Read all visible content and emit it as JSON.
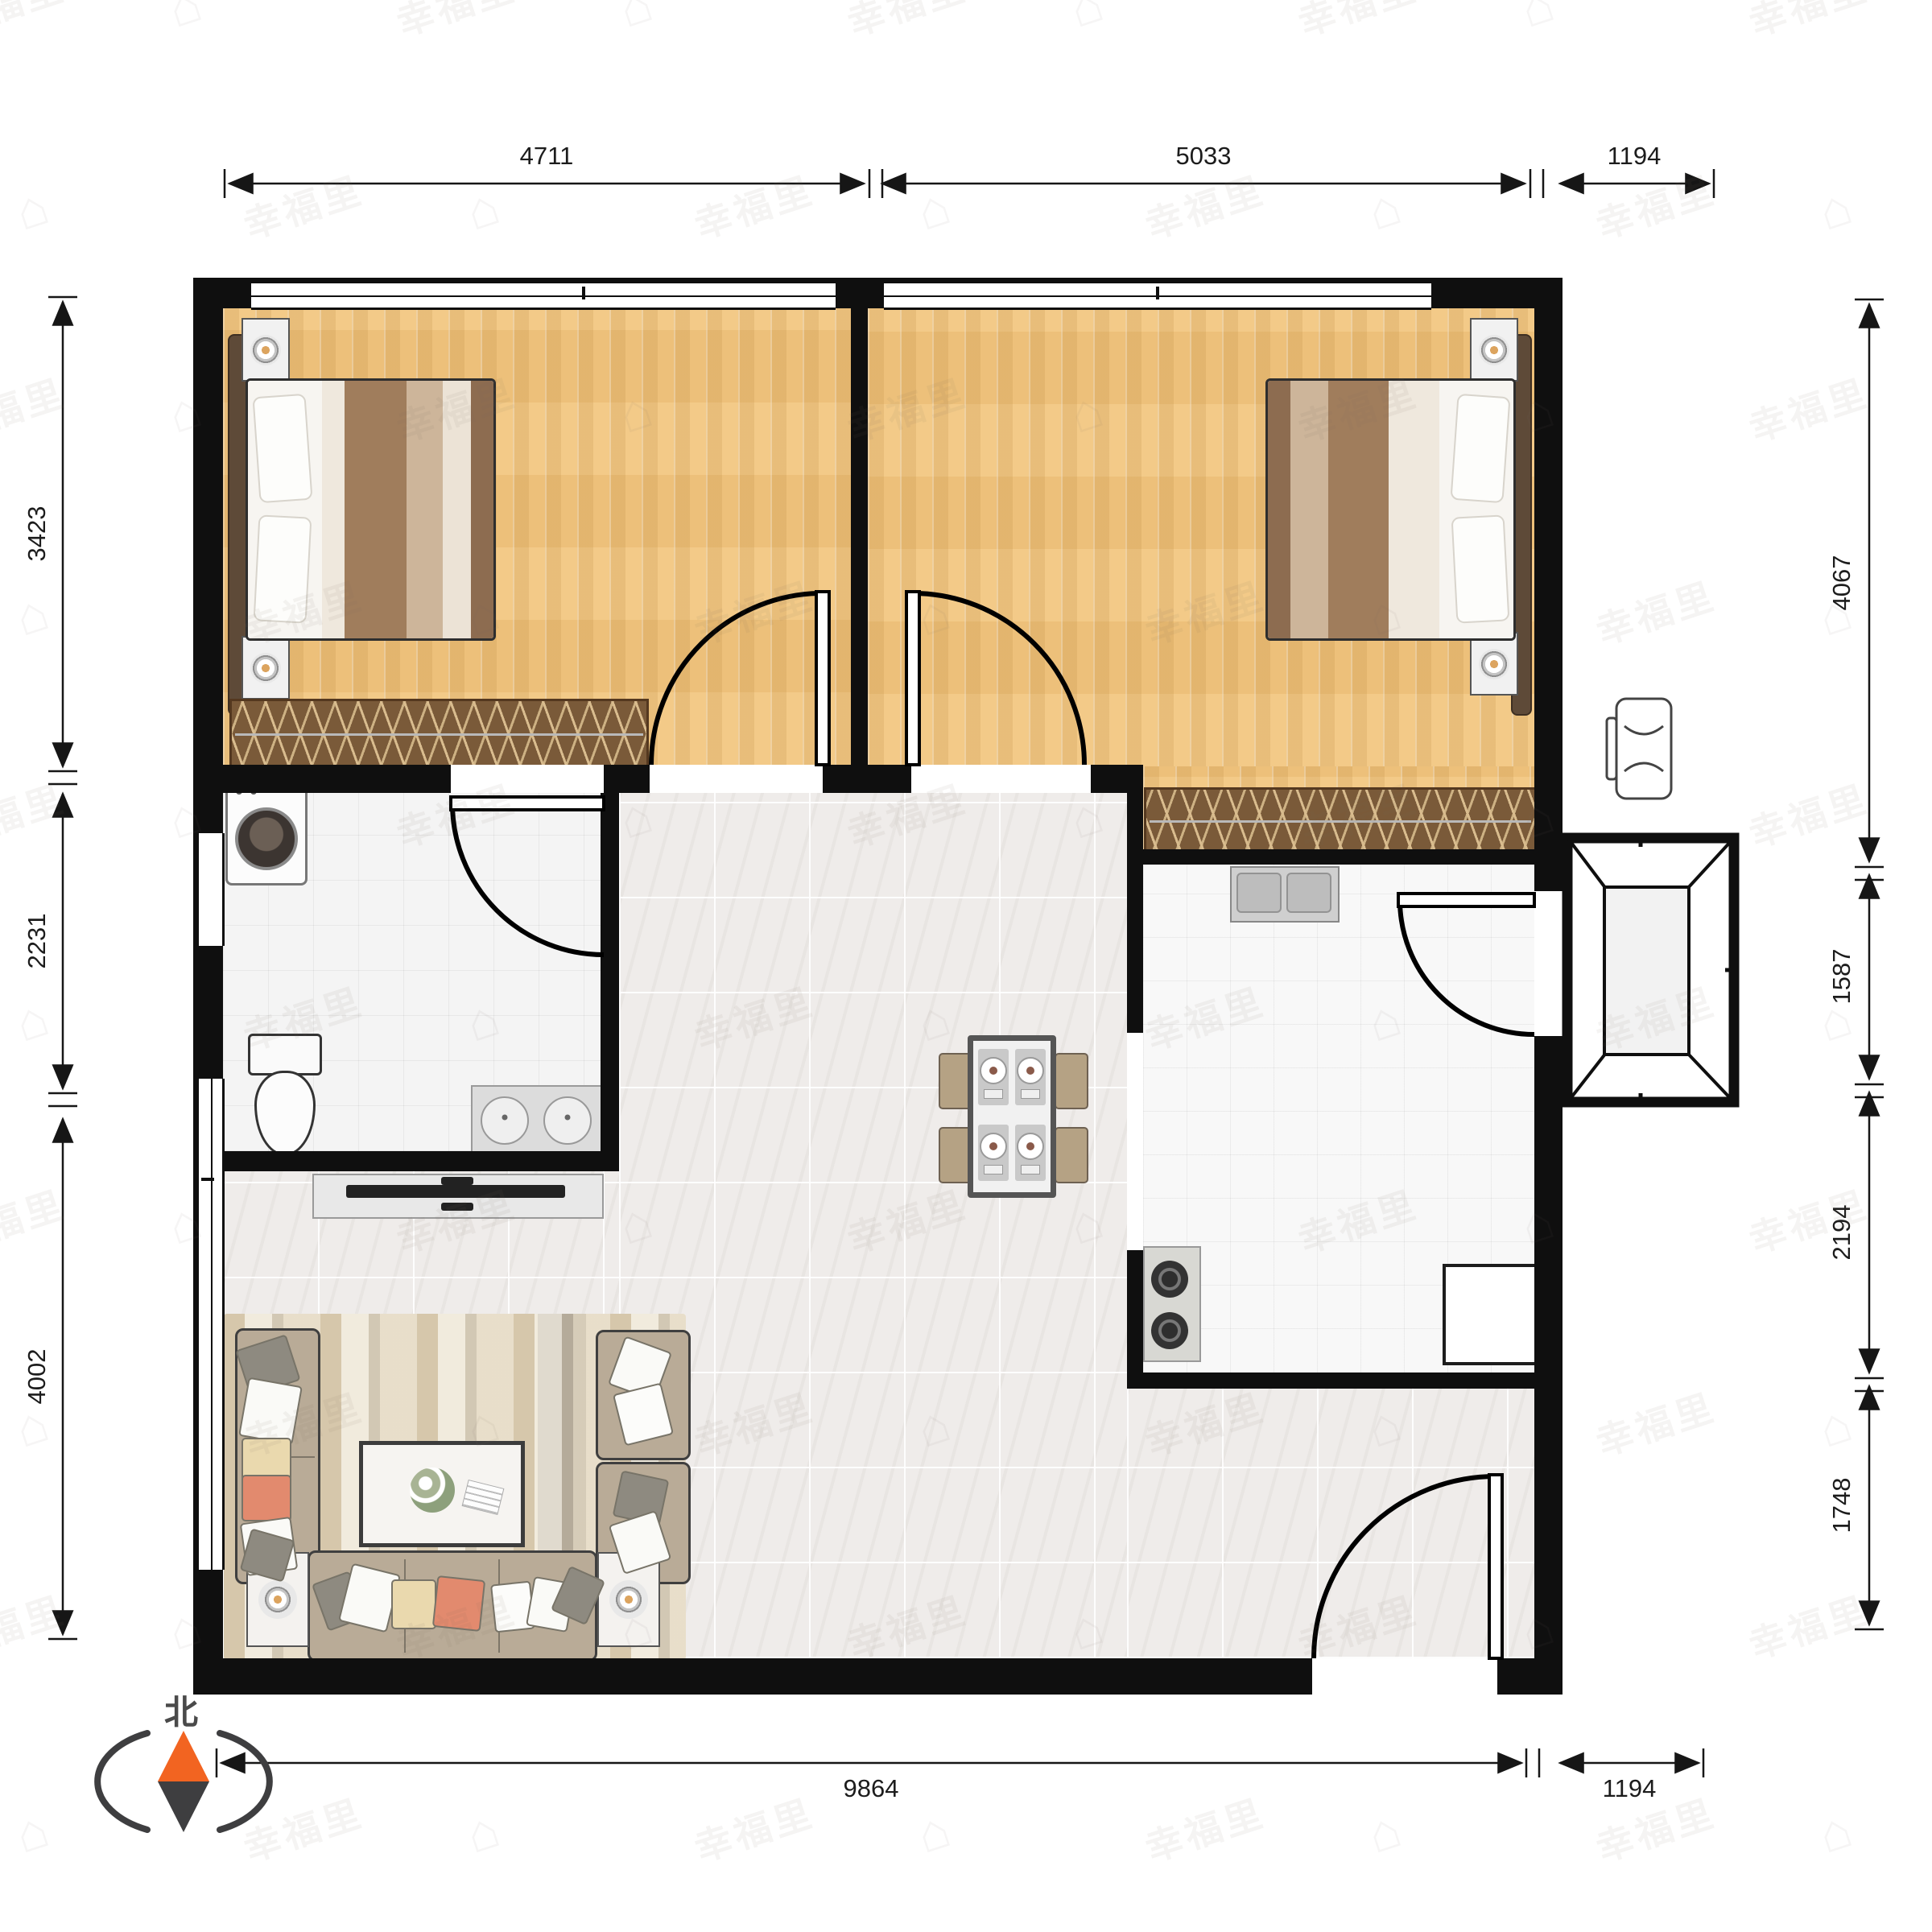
{
  "watermark": {
    "text": "幸福里",
    "logo_glyph": "⌂"
  },
  "compass": {
    "north_label": "北",
    "needle_color": "#f26421",
    "body_color": "#3e3e40"
  },
  "dimensions": {
    "top": [
      {
        "label": "4711"
      },
      {
        "label": "5033"
      },
      {
        "label": "1194"
      }
    ],
    "bottom": [
      {
        "label": "9864"
      },
      {
        "label": "1194"
      }
    ],
    "left": [
      {
        "label": "3423"
      },
      {
        "label": "2231"
      },
      {
        "label": "4002"
      }
    ],
    "right": [
      {
        "label": "4067"
      },
      {
        "label": "1587"
      },
      {
        "label": "2194"
      },
      {
        "label": "1748"
      }
    ]
  },
  "colors": {
    "wall": "#0f0f0f",
    "wood_floor": "#f2c67f",
    "bath_tile": "#f4f4f4",
    "marble_floor": "#efecea",
    "wardrobe": "#7a5a39",
    "sofa": "#b9ab97",
    "compass_orange": "#f26421"
  }
}
